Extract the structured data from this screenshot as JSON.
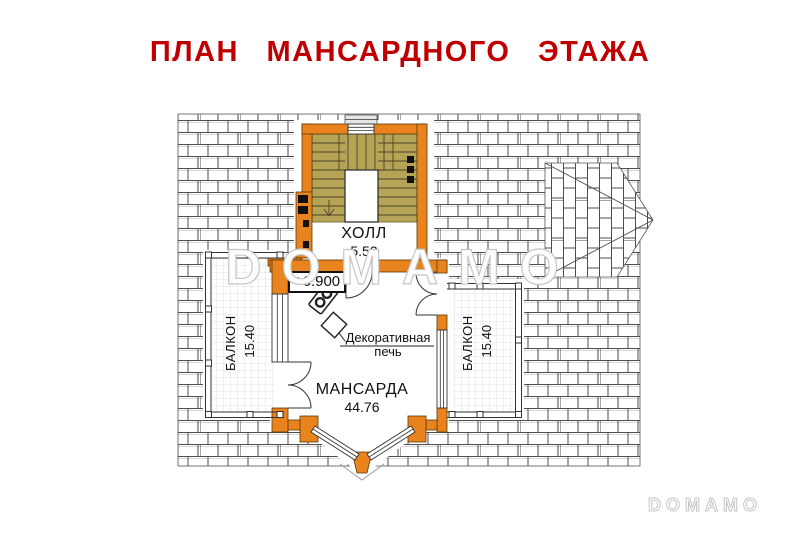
{
  "title": "ПЛАН МАНСАРДНОГО ЭТАЖА",
  "rooms": {
    "hall": {
      "name": "ХОЛЛ",
      "area": "5.52"
    },
    "mansarda": {
      "name": "МАНСАРДА",
      "area": "44.76"
    },
    "balcony_left": {
      "name": "БАЛКОН",
      "area": "15.40"
    },
    "balcony_right": {
      "name": "БАЛКОН",
      "area": "15.40"
    }
  },
  "annotations": {
    "elevation_mark": "+6.900",
    "stove_label_line1": "Декоративная",
    "stove_label_line2": "печь"
  },
  "watermark": {
    "center": "DOMAMO",
    "corner": "DOMAMO"
  },
  "colors": {
    "title": "#c00000",
    "wall": "#e8831e",
    "stairs": "#b5a455",
    "watermark": "#c6c6c6"
  }
}
